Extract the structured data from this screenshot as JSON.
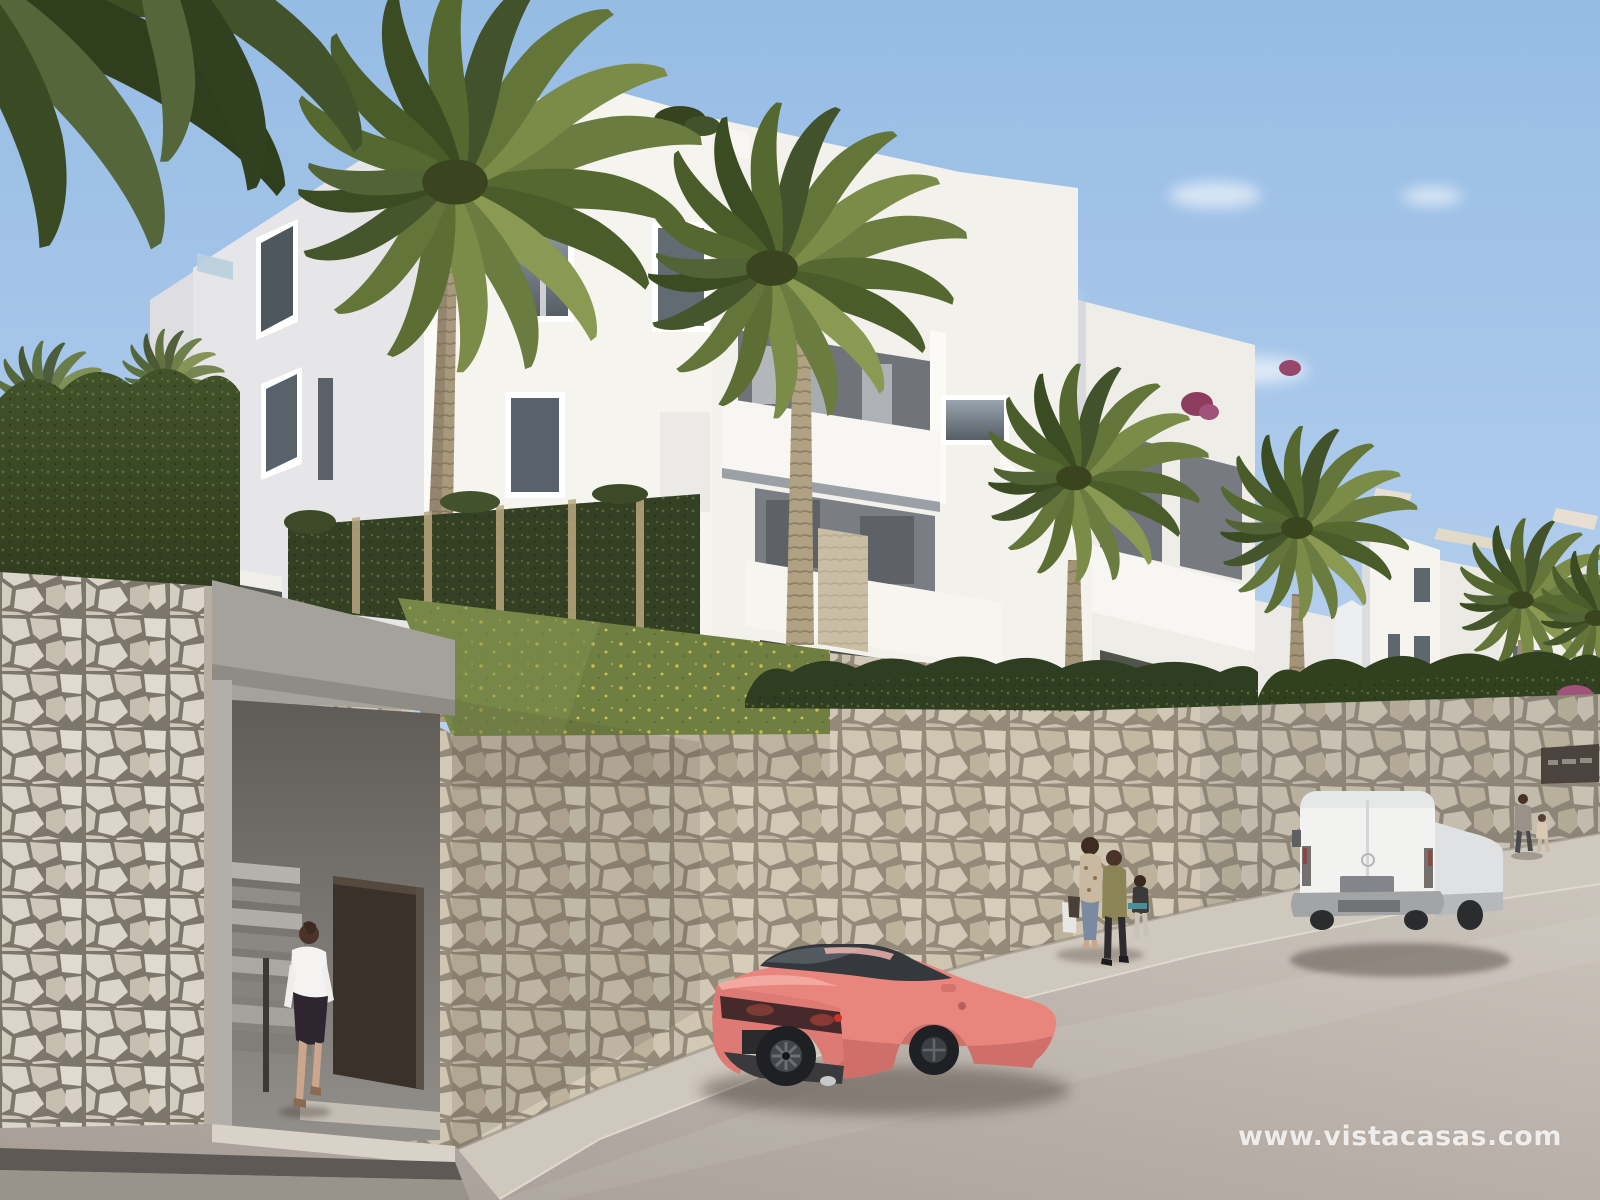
{
  "meta": {
    "kind": "architectural-exterior-render",
    "width_px": 1600,
    "height_px": 1200,
    "setting": "New-build white apartment complex on a hillside above a street, sunny day, CGI render"
  },
  "watermark": {
    "text": "www.vistacasas.com",
    "color": "#ffffff",
    "opacity": 0.78
  },
  "scene": {
    "sky": {
      "top": "#9cc0e6",
      "horizon": "#cfe0f3",
      "clouds": "wispy white, right of center"
    },
    "architecture": {
      "facade_lit": "#f6f4ef",
      "facade_shadow": "#e4e4e8",
      "balcony_recess": "#70747a",
      "parapet": "#f8f6f2",
      "window_glass": "#5e666e",
      "balustrade_glass": "#b9cfdd",
      "pergola_sail": "#d8c7a8",
      "stone_pillar": "#c9bda4"
    },
    "vegetation": {
      "palm_trees": 6,
      "palm_green": "#64753a",
      "palm_dark": "#42522a",
      "palm_light": "#8e9c52",
      "trunk": "#a8997c",
      "hedge_dark": "#2f3d20",
      "vertical_garden": "#334024",
      "grass": "#6f7f42",
      "yellow_flowers": "#d9c94e",
      "bougainvillea": "#a0527a"
    },
    "stone_wall": {
      "stone_light": "#d4cdc0",
      "stone_tan": "#c9bfae",
      "joints": "#8d8476",
      "entrance": "concrete stairwell opening with dark brown door",
      "sign_plaque_color": "#4b443e"
    },
    "street": {
      "road": "#b3aba3",
      "sidewalk": "#cfc8bd",
      "gutter": "#5e5954"
    },
    "vehicles": [
      {
        "type": "sports-coupe",
        "color": "#e8867e",
        "view": "rear three-quarter, parked center foreground"
      },
      {
        "type": "panel-van",
        "color": "#f2f2f1",
        "view": "rear, parked right along curb"
      }
    ],
    "people": [
      {
        "label": "woman entering stairwell door",
        "clothing": "white shirt, dark skirt"
      },
      {
        "label": "woman carrying shopping bags",
        "clothing": "floral top, jeans"
      },
      {
        "label": "person in olive jacket",
        "clothing": "dark trousers"
      },
      {
        "label": "child holding teal board",
        "clothing": "dark top, light trousers"
      },
      {
        "label": "adult walking away near van",
        "clothing": "grey t-shirt"
      },
      {
        "label": "child walking away near van",
        "clothing": "light outfit"
      }
    ]
  }
}
